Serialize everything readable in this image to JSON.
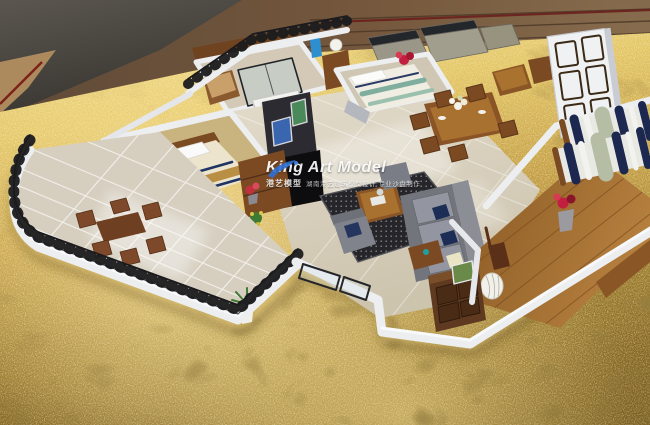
{
  "image": {
    "type": "photograph",
    "subject": "Aerial view of a miniature cut-away apartment scale model with furnished rooms and a curved balcony, displayed on a gold sequined fabric table"
  },
  "watermark": {
    "title": "King Art Model",
    "subtitle": "港艺模型",
    "tagline": "湖南港艺建筑模型设计 专业沙盘制作"
  },
  "scene_elements": [
    "curved glass balcony with black railing and outdoor wood dining set",
    "master bedroom with striped bed and blue TV panel",
    "bathroom with glass shower and bathtub",
    "living room with gray sofas, navy pillows, dark patterned rug and TV wall",
    "dining room with wood table, chairs and white flowers",
    "second bedroom with teal striped bed and wardrobes",
    "tall white entry door panel",
    "right bedroom wing with two navy striped beds on wood floor",
    "entry hall with drawer cabinet, woven lamp and red flower pot"
  ],
  "colors": {
    "gold_bright": "#f3e093",
    "gold_mid": "#c29c44",
    "gold_dark": "#8a6b26",
    "backdrop_charcoal": "#4b4743",
    "backdrop_wood": "#6b5036",
    "wall_white": "#eceef0",
    "tile_floor": "#d8d1c1",
    "wood_floor": "#a06b32",
    "carpet_tan": "#c9b480",
    "sofa_gray": "#84878d",
    "navy": "#1d2850",
    "tv_blue": "#2e8fd0",
    "railing_black": "#1b1b1e",
    "plant_green": "#3f7a34",
    "flower_red": "#c22040",
    "watermark_blue": "#2e6fd2"
  }
}
